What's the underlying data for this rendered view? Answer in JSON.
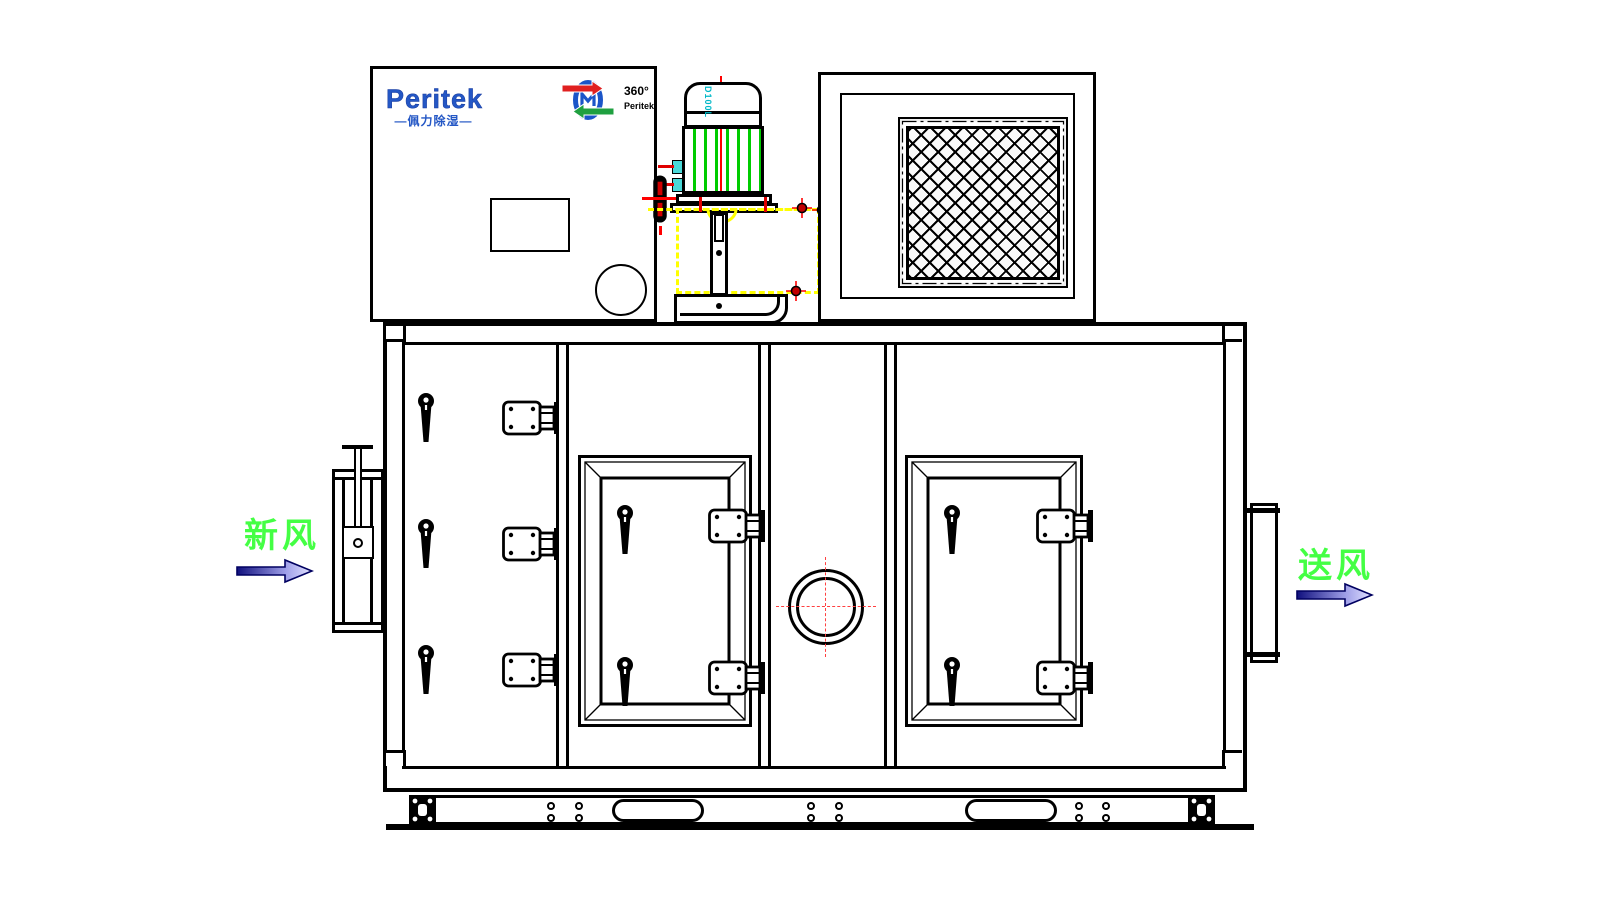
{
  "diagram": {
    "kind": "dehumidifier-unit-front-elevation",
    "logo": {
      "brand": "Peritek",
      "tagline": "—佩力除湿—"
    },
    "rotor_badge": {
      "degree": "360°",
      "brand": "Peritek"
    },
    "motor": {
      "frame_label": "D100L"
    },
    "labels": {
      "fresh_air": "新风",
      "supply_air": "送风"
    },
    "colors": {
      "line": "#000000",
      "centerline_red": "#FF0000",
      "motor_fin_green": "#00CC00",
      "hidden_yellow": "#FFFF00",
      "label_green": "#44FF44",
      "logo_blue": "#2457C5",
      "terminal_cyan": "#00C8C8",
      "arrow_navy": "#10107E",
      "arrow_light": "#E2E2FF"
    }
  }
}
